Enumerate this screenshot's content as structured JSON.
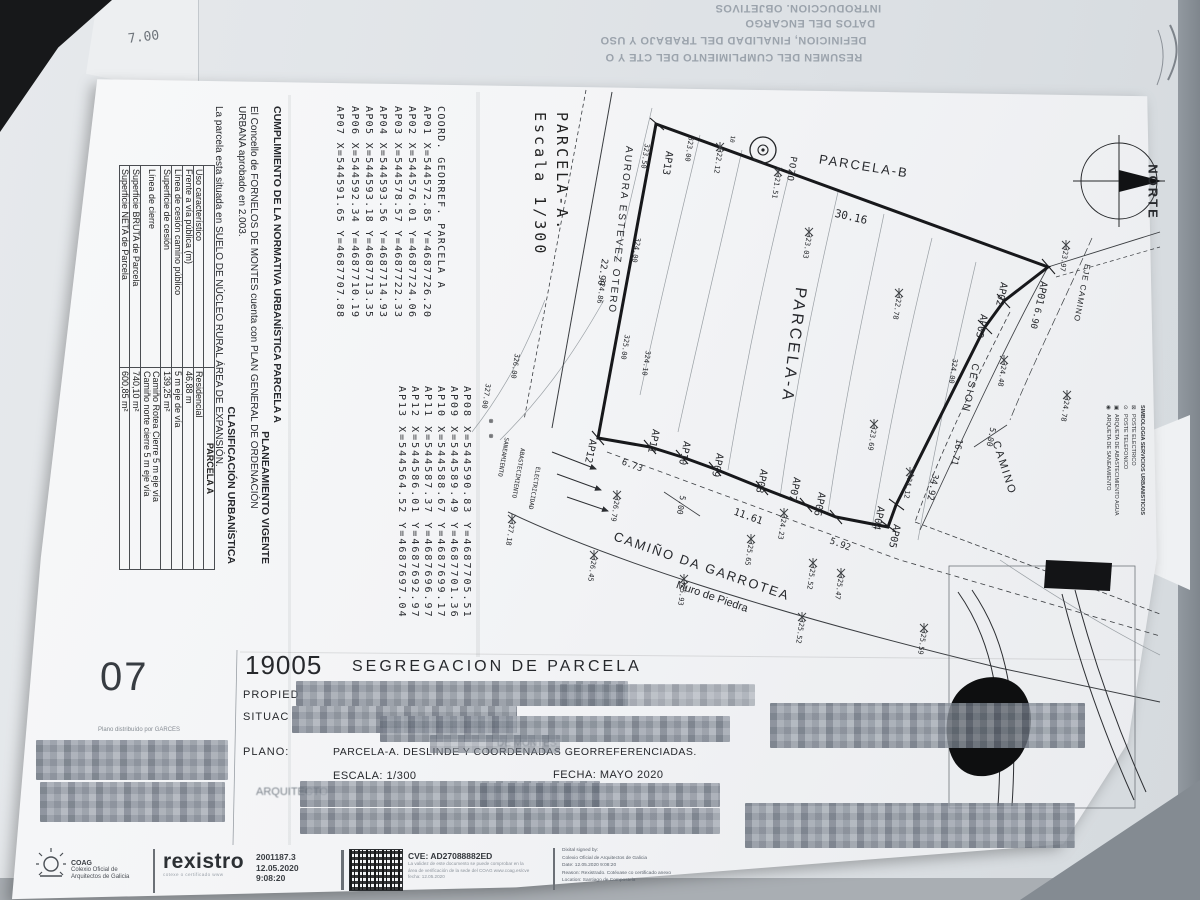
{
  "back_sheet": {
    "l1": "INTRODUCCION. OBJETIVOS",
    "l2": "DATOS DEL ENCARGO",
    "l3": "DEFINICION, FINALIDAD DEL TRABAJO Y USO",
    "l4": "RESUMEN DEL CUMPLIMIENTO DEL CTE Y O"
  },
  "notes": {
    "handwritten": "7.00"
  },
  "normativa": {
    "title": "CUMPLIMIENTO DE LA NORMATIVA URBANÍSTICA PARCELA A",
    "heading_planeamiento": "PLANEAMIENTO VIGENTE",
    "para1a": "El Concello de FORNELOS DE MONTES cuenta con PLAN GENERAL DE ORDENACIÓN",
    "para1b": "URBANA aprobado en 2.003.",
    "heading_clasificacion": "CLASIFICACIÓN URBANÍSTICA",
    "para2": "La parcela esta situada en SUELO DE NÚCLEO RURAL ÁREA DE EXPANSIÓN."
  },
  "coords": {
    "header": "COORD. GEORREF. PARCELA A",
    "group1": [
      "AP01 X=544572.85  Y=4687726.20",
      "AP02 X=544576.01  Y=4687724.06",
      "AP03 X=544578.57  Y=4687722.33",
      "AP04 X=544593.56  Y=4687714.93",
      "AP05 X=544593.18  Y=4687713.35",
      "AP06 X=544592.34  Y=4687710.19",
      "AP07 X=544591.65  Y=4687707.88"
    ],
    "group2": [
      "AP08 X=544590.83  Y=4687705.51",
      "AP09 X=544589.49  Y=4687701.36",
      "AP10 X=544588.67  Y=4687699.17",
      "AP11 X=544587.37  Y=4687696.97",
      "AP12 X=544586.01  Y=4687692.97",
      "AP13 X=544564.52  Y=4687697.04"
    ]
  },
  "escala_block": {
    "line1": "PARCELA-A.",
    "line2": "Escala 1/300"
  },
  "table": {
    "header": "PARCELA A",
    "rows": [
      {
        "l": "Uso característico",
        "v": "Residencial"
      },
      {
        "l": "Frente a vía pública (m)",
        "v": "46,88 m"
      },
      {
        "l": "Línea de cesión camino público",
        "v": "5 m eje de vía"
      },
      {
        "l": "Superficie de cesión",
        "v": "139,25 m²"
      },
      {
        "l": "Línea de cierre",
        "v": "Camiño Rotea Cierre 5 m eje vía\nCamiño norte cierre 5 m eje vía"
      },
      {
        "l": "Superficie BRUTA de Parcela",
        "v": "740,10 m²"
      },
      {
        "l": "Superficie NETA de Parcela",
        "v": "600,85 m²"
      }
    ]
  },
  "legend": {
    "title": "SIMBOLOGIA SERVICIOS URBANISTICOS",
    "items": [
      {
        "sym": "⊠",
        "label": "POSTE ELECTRICO"
      },
      {
        "sym": "⊙",
        "label": "POSTE TELEFONICO"
      },
      {
        "sym": "▣",
        "label": "ARQUETA DE ABASTECIMIENTO AGUA"
      },
      {
        "sym": "◉",
        "label": "ARQUETA DE SANEAMIENTO"
      }
    ]
  },
  "plan_labels": [
    {
      "t": "AP13",
      "x": 667,
      "y": 163,
      "r": 99,
      "s": 10
    },
    {
      "t": "AP01",
      "x": 1041,
      "y": 293,
      "r": 102,
      "s": 10
    },
    {
      "t": "AP02",
      "x": 1001,
      "y": 294,
      "r": 102,
      "s": 10
    },
    {
      "t": "AP03",
      "x": 981,
      "y": 326,
      "r": 102,
      "s": 10
    },
    {
      "t": "AP04",
      "x": 878,
      "y": 518,
      "r": 102,
      "s": 10
    },
    {
      "t": "AP05",
      "x": 894,
      "y": 536,
      "r": 102,
      "s": 10
    },
    {
      "t": "AP06",
      "x": 819,
      "y": 504,
      "r": 102,
      "s": 10
    },
    {
      "t": "AP07",
      "x": 794,
      "y": 489,
      "r": 102,
      "s": 10
    },
    {
      "t": "AP08",
      "x": 761,
      "y": 481,
      "r": 102,
      "s": 10
    },
    {
      "t": "AP09",
      "x": 717,
      "y": 465,
      "r": 102,
      "s": 10
    },
    {
      "t": "AP10",
      "x": 684,
      "y": 453,
      "r": 102,
      "s": 10
    },
    {
      "t": "AP11",
      "x": 653,
      "y": 441,
      "r": 102,
      "s": 10
    },
    {
      "t": "AP12",
      "x": 590,
      "y": 451,
      "r": 102,
      "s": 10
    },
    {
      "t": "30.16",
      "x": 851,
      "y": 217,
      "r": 13,
      "s": 11
    },
    {
      "t": "6.90",
      "x": 1035,
      "y": 318,
      "r": 104,
      "s": 9
    },
    {
      "t": "22.90",
      "x": 602,
      "y": 272,
      "r": 99,
      "s": 9
    },
    {
      "t": "6.73",
      "x": 632,
      "y": 466,
      "r": 20,
      "s": 9
    },
    {
      "t": "11.61",
      "x": 748,
      "y": 517,
      "r": 20,
      "s": 10
    },
    {
      "t": "5.92",
      "x": 840,
      "y": 545,
      "r": 20,
      "s": 9
    },
    {
      "t": "5.00",
      "x": 681,
      "y": 505,
      "r": 100,
      "s": 8
    },
    {
      "t": "5.00",
      "x": 991,
      "y": 437,
      "r": 102,
      "s": 8
    },
    {
      "t": "16.71",
      "x": 956,
      "y": 452,
      "r": 102,
      "s": 9
    },
    {
      "t": "34.92",
      "x": 932,
      "y": 487,
      "r": 102,
      "s": 9
    },
    {
      "t": "322.12",
      "x": 718,
      "y": 161,
      "r": 99,
      "s": 7
    },
    {
      "t": "321.51",
      "x": 776,
      "y": 186,
      "r": 99,
      "s": 7
    },
    {
      "t": "323.00",
      "x": 689,
      "y": 149,
      "r": 99,
      "s": 7
    },
    {
      "t": "323.50",
      "x": 645,
      "y": 156,
      "r": 99,
      "s": 7
    },
    {
      "t": "324.00",
      "x": 636,
      "y": 250,
      "r": 99,
      "s": 7
    },
    {
      "t": "324.86",
      "x": 601,
      "y": 291,
      "r": 99,
      "s": 7
    },
    {
      "t": "325.00",
      "x": 625,
      "y": 347,
      "r": 99,
      "s": 7
    },
    {
      "t": "324.10",
      "x": 646,
      "y": 363,
      "r": 99,
      "s": 7
    },
    {
      "t": "326.00",
      "x": 515,
      "y": 366,
      "r": 99,
      "s": 7
    },
    {
      "t": "327.00",
      "x": 486,
      "y": 396,
      "r": 99,
      "s": 7
    },
    {
      "t": "323.03",
      "x": 807,
      "y": 246,
      "r": 99,
      "s": 7
    },
    {
      "t": "322.78",
      "x": 897,
      "y": 307,
      "r": 99,
      "s": 7
    },
    {
      "t": "323.97",
      "x": 1064,
      "y": 259,
      "r": 99,
      "s": 7
    },
    {
      "t": "324.48",
      "x": 1002,
      "y": 374,
      "r": 99,
      "s": 7
    },
    {
      "t": "324.78",
      "x": 1065,
      "y": 409,
      "r": 99,
      "s": 7
    },
    {
      "t": "324.00",
      "x": 953,
      "y": 371,
      "r": 99,
      "s": 7
    },
    {
      "t": "323.69",
      "x": 872,
      "y": 438,
      "r": 99,
      "s": 7
    },
    {
      "t": "324.12",
      "x": 908,
      "y": 486,
      "r": 99,
      "s": 7
    },
    {
      "t": "326.79",
      "x": 615,
      "y": 509,
      "r": 99,
      "s": 7
    },
    {
      "t": "326.45",
      "x": 592,
      "y": 569,
      "r": 99,
      "s": 7
    },
    {
      "t": "325.93",
      "x": 682,
      "y": 593,
      "r": 99,
      "s": 7
    },
    {
      "t": "325.65",
      "x": 749,
      "y": 553,
      "r": 99,
      "s": 7
    },
    {
      "t": "324.23",
      "x": 782,
      "y": 527,
      "r": 99,
      "s": 7
    },
    {
      "t": "325.52",
      "x": 811,
      "y": 577,
      "r": 99,
      "s": 7
    },
    {
      "t": "325.47",
      "x": 839,
      "y": 587,
      "r": 99,
      "s": 7
    },
    {
      "t": "325.52",
      "x": 800,
      "y": 631,
      "r": 99,
      "s": 7
    },
    {
      "t": "325.59",
      "x": 922,
      "y": 642,
      "r": 99,
      "s": 7
    },
    {
      "t": "327.18",
      "x": 510,
      "y": 533,
      "r": 99,
      "s": 7
    },
    {
      "t": "10",
      "x": 732,
      "y": 139,
      "r": 99,
      "s": 6
    },
    {
      "t": "PARCELA-A",
      "x": 793,
      "y": 345,
      "r": 97,
      "s": 16,
      "ls": 3,
      "f": "s",
      "n": "parcela-a-area-label"
    },
    {
      "t": "PARCELA-B",
      "x": 864,
      "y": 166,
      "r": 9,
      "s": 13,
      "ls": 2,
      "f": "s",
      "n": "parcela-b-area-label"
    },
    {
      "t": "POZO",
      "x": 791,
      "y": 169,
      "r": 99,
      "s": 9,
      "ls": 1,
      "n": "pozo-label"
    },
    {
      "t": "AURORA ESTEVEZ OTERO",
      "x": 620,
      "y": 230,
      "r": 96,
      "s": 10,
      "ls": 2,
      "f": "s",
      "n": "street-aurora-estevez-otero"
    },
    {
      "t": "CAMIÑO DA GARROTEA",
      "x": 702,
      "y": 566,
      "r": 19,
      "s": 13,
      "ls": 2,
      "f": "s",
      "n": "street-camino-da-garrotea"
    },
    {
      "t": "Muro de Piedra",
      "x": 712,
      "y": 597,
      "r": 19,
      "s": 11,
      "f": "s",
      "n": "muro-de-piedra-label"
    },
    {
      "t": "CAMINO",
      "x": 1004,
      "y": 468,
      "r": 72,
      "s": 11,
      "ls": 2,
      "f": "s",
      "n": "camino-label"
    },
    {
      "t": "EJE CAMINO",
      "x": 1082,
      "y": 293,
      "r": 101,
      "s": 8,
      "ls": 1,
      "f": "s",
      "n": "eje-camino-label"
    },
    {
      "t": "CESION",
      "x": 970,
      "y": 388,
      "r": 102,
      "s": 10,
      "ls": 2,
      "f": "s",
      "n": "cesion-label"
    },
    {
      "t": "NORTE",
      "x": 1153,
      "y": 192,
      "r": 90,
      "s": 13,
      "ls": 2,
      "b": 1,
      "f": "s",
      "n": "north-label"
    },
    {
      "t": "SANEAMIENTO",
      "x": 503,
      "y": 457,
      "r": 100,
      "s": 6
    },
    {
      "t": "ABASTECIMIENTO",
      "x": 518,
      "y": 473,
      "r": 100,
      "s": 6
    },
    {
      "t": "ELECTRICIDAD",
      "x": 534,
      "y": 488,
      "r": 100,
      "s": 6
    },
    {
      "t": "⊗",
      "x": 491,
      "y": 421,
      "r": 0,
      "s": 8
    },
    {
      "t": "⊗",
      "x": 491,
      "y": 436,
      "r": 0,
      "s": 8
    }
  ],
  "title_block": {
    "number": "19005",
    "title": "SEGREGACION DE PARCELA",
    "row1": "PROPIED",
    "row2": "SITUAC",
    "ghost": "DE MONTES",
    "plano_label": "PLANO:",
    "plano": "PARCELA-A. DESLINDE Y COORDENADAS GEORREFERENCIADAS.",
    "escala": "ESCALA: 1/300",
    "fecha": "FECHA: MAYO 2020",
    "arquitecto": "ARQUITECTO"
  },
  "sheet_number": {
    "number": "07",
    "note": "Plano distribuído por GARCÉS"
  },
  "stamp_bar": {
    "coag_acronym": "COAG",
    "coag_name1": "Colexio Oficial de",
    "coag_name2": "Arquitectos de Galicia",
    "rexistro": "rexistro",
    "rexistro_tag": "cotexe o certificado www",
    "file_number": "2001187.3",
    "date": "12.05.2020",
    "time": "9:08:20",
    "cve": "CVE: AD27088882ED",
    "cve_note1": "La validez de este documento se puede comprobar en la",
    "cve_note2": "área de verificación de la sede del COAG www.coag.es/cve",
    "cve_note3": "fecha: 12.05.2020",
    "sig1": "Dixital signed by:",
    "sig2": "Colexio Oficial de Arquitectos de Galicia",
    "sig3": "Date: 12.05.2020 9:08:20",
    "sig4": "Reason: Rexistrado. Cotéxase co certificado anexo",
    "sig5": "Location: Santiago de Compostela"
  }
}
